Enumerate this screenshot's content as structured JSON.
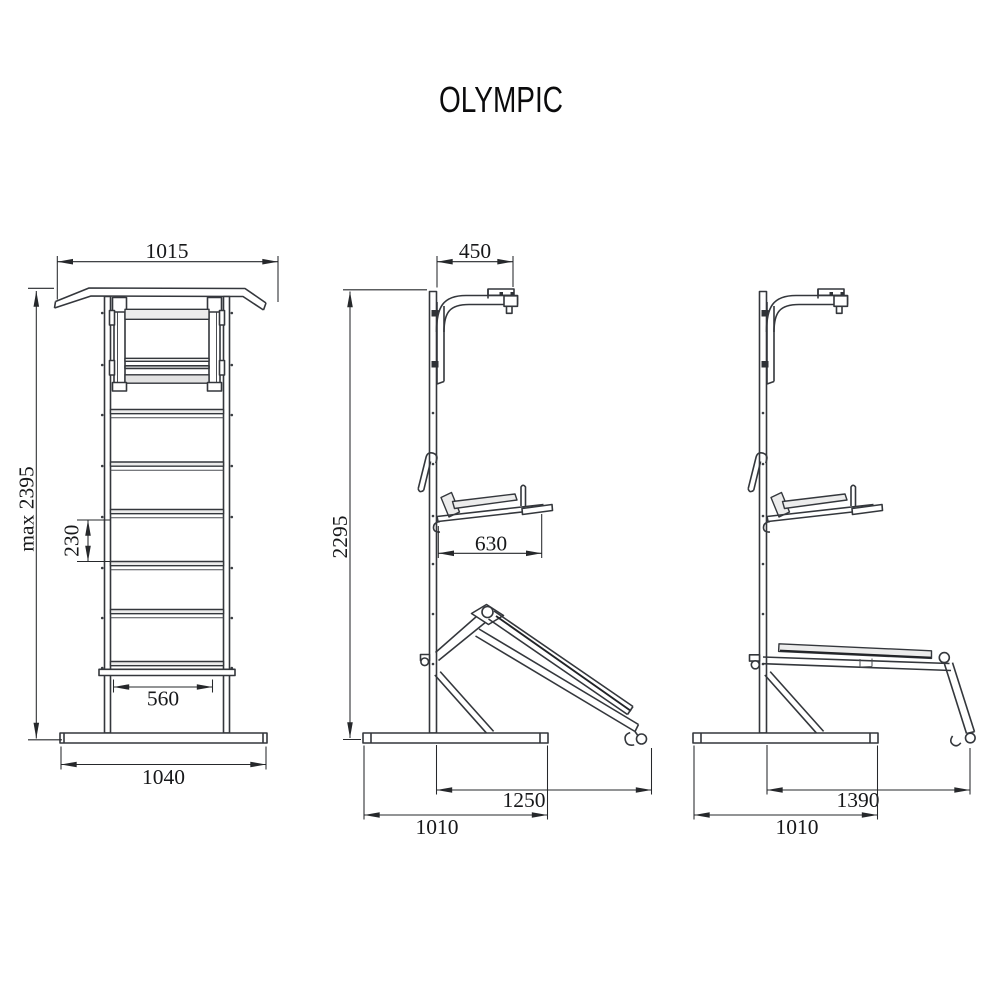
{
  "title": "OLYMPIC",
  "views": {
    "front": {
      "top_width": "1015",
      "max_height": "max 2395",
      "rung_spacing": "230",
      "inner_width": "560",
      "base_width": "1040"
    },
    "side_bench_lowered": {
      "arm_depth": "450",
      "height": "2295",
      "seat_depth": "630",
      "bench_reach": "1250",
      "base_depth": "1010"
    },
    "side_bench_raised": {
      "bench_reach": "1390",
      "base_depth": "1010"
    }
  }
}
